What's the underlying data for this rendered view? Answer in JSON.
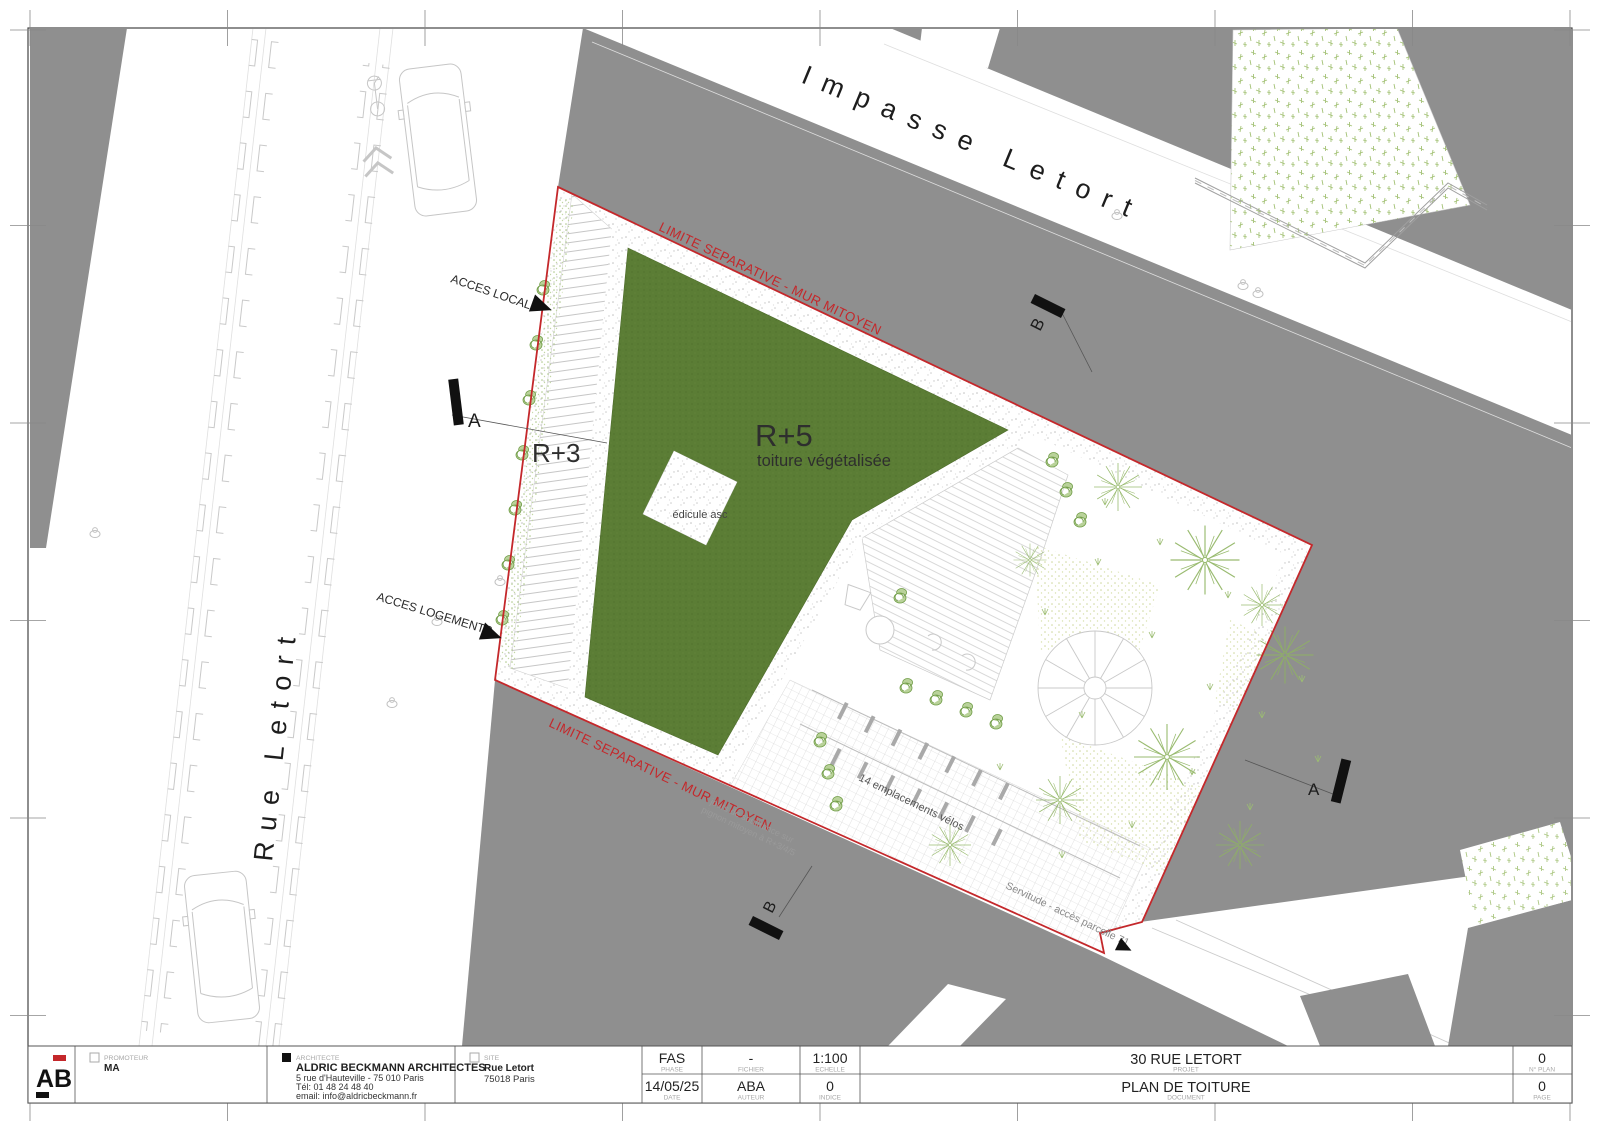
{
  "colors": {
    "paper": "#ffffff",
    "neighbor_gray": "#8f8f8f",
    "boundary_red": "#c4282b",
    "roof_green": "#5b7d35",
    "line_light": "#c8c8c8",
    "vegetation_green": "#95b96a",
    "text_dark": "#1d1d1d",
    "text_gray": "#9a9a9a"
  },
  "streets": {
    "impasse": "Impasse Letort",
    "rue": "Rue Letort"
  },
  "plan": {
    "limite_top": "LIMITE SEPARATIVE - MUR MITOYEN",
    "limite_bottom": "LIMITE SEPARATIVE - MUR MITOYEN",
    "r5": "R+5",
    "r5_sub": "toiture végétalisée",
    "r3": "R+3",
    "edicule": "édicule asc",
    "acces_local": "ACCES LOCAL",
    "acces_logements": "ACCES LOGEMENTS",
    "velos": "14 emplacements vélos",
    "servitude": "Servitude - accès parcelle 71",
    "jours_1": "jours de souffrance sur",
    "jours_2": "pignon mitoyen à R+3/4/5",
    "section_a": "A",
    "section_b": "B"
  },
  "title_block": {
    "logo": "AB",
    "promoteur_label": "PROMOTEUR",
    "promoteur": "MA",
    "architecte_label": "ARCHITECTE",
    "architecte_name": "ALDRIC BECKMANN ARCHITECTES",
    "architecte_addr1": "5 rue d'Hauteville - 75 010 Paris",
    "architecte_addr2": "Tél: 01 48 24 48 40",
    "architecte_addr3": "email: info@aldricbeckmann.fr",
    "site_label": "SITE",
    "site_name": "Rue Letort",
    "site_city": "75018 Paris",
    "phase_label": "PHASE",
    "phase": "FAS",
    "fichier_label": "FICHIER",
    "fichier": "-",
    "echelle_label": "ECHELLE",
    "echelle": "1:100",
    "date_label": "DATE",
    "date": "14/05/25",
    "auteur_label": "AUTEUR",
    "auteur": "ABA",
    "indice_label": "INDICE",
    "indice": "0",
    "projet_label": "PROJET",
    "projet": "30 RUE LETORT",
    "document_label": "DOCUMENT",
    "document": "PLAN DE TOITURE",
    "nplan_label": "N° PLAN",
    "nplan": "0",
    "page_label": "PAGE",
    "page": "0"
  }
}
